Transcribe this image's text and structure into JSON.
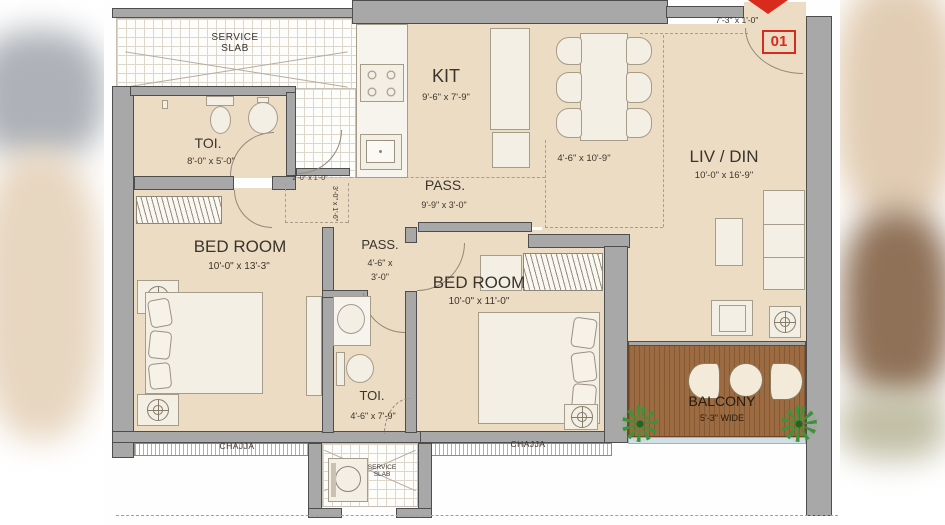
{
  "plan": {
    "unit_number": "01",
    "colors": {
      "floor": "#ECDCC3",
      "wall": "#A8A8A8",
      "balcony_wood": "#9C6B42",
      "accent_red": "#D92A1E",
      "plant_green": "#3F9238"
    },
    "rooms": {
      "service_slab_top": {
        "line1": "SERVICE",
        "line2": "SLAB"
      },
      "toi1": {
        "name": "TOI.",
        "dims": "8'-0\" x 5'-0\""
      },
      "kitchen": {
        "name": "KIT",
        "dims": "9'-6\" x 7'-9\""
      },
      "dining": {
        "dims": "4'-6\" x 10'-9\""
      },
      "livdin": {
        "name": "LIV / DIN",
        "dims": "10'-0\" x 16'-9\""
      },
      "pass1": {
        "name": "PASS.",
        "dims": "9'-9\" x 3'-0\""
      },
      "pass2": {
        "name": "PASS.",
        "dims_line1": "4'-6\" x",
        "dims_line2": "3'-0\""
      },
      "bed1": {
        "name": "BED ROOM",
        "dims": "10'-0\" x 13'-3\""
      },
      "bed2": {
        "name": "BED ROOM",
        "dims": "10'-0\" x 11'-0\""
      },
      "toi2": {
        "name": "TOI.",
        "dims": "4'-6\" x 7'-9\""
      },
      "balcony": {
        "name": "BALCONY",
        "dims": "5'-3\" WIDE"
      },
      "service_slab_bottom": {
        "line1": "SERVICE",
        "line2": "SLAB"
      }
    },
    "annotations": {
      "entry_niche_dims": "7'-3\" x 1'-0\"",
      "foyer_dims_h": "2'-0\" x 1'-0\"",
      "foyer_dims_v": "3'-0\" x 1'-6\"",
      "chajja_left": "CHAJJA",
      "chajja_right": "CHAJJA"
    },
    "icons": {
      "entry-arrow": "red-down-triangle",
      "ceiling-fan": "circle-crosshair",
      "toilet": "tank-and-bowl",
      "wash-basin": "circle-with-tap",
      "stove": "four-burner-hob",
      "washing-machine": "square-with-drum",
      "plant": "green-starburst"
    }
  }
}
